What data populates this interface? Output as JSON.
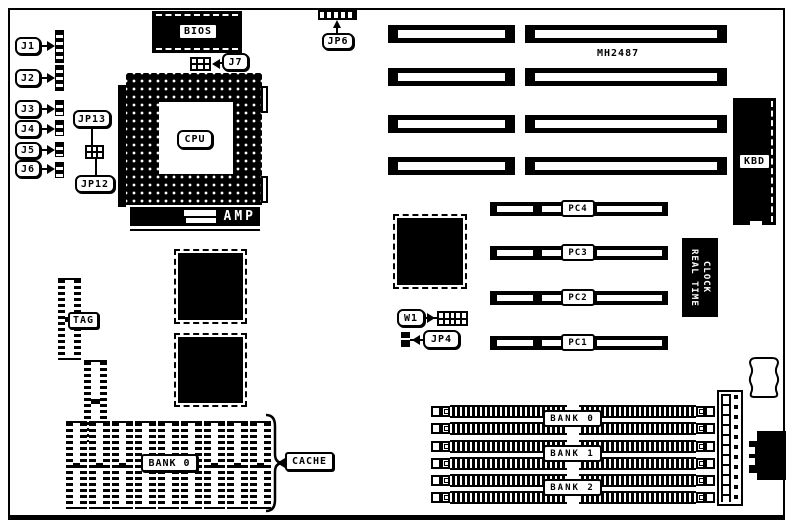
{
  "board": {
    "part_number": "MH2487",
    "left_connectors": [
      "J1",
      "J2",
      "J3",
      "J4",
      "J5",
      "J6"
    ],
    "jumpers": {
      "jp13": "JP13",
      "jp12": "JP12",
      "j7": "J7",
      "jp6": "JP6",
      "w1": "W1",
      "jp4": "JP4"
    },
    "chips": {
      "bios": "BIOS",
      "cpu": "CPU",
      "amp": "AMP",
      "kbd": "KBD",
      "tag": "TAG",
      "rtc_line1": "REAL TIME",
      "rtc_line2": "CLOCK"
    },
    "pci_slots": [
      "PC4",
      "PC3",
      "PC2",
      "PC1"
    ],
    "simm_banks": [
      "BANK 0",
      "BANK 1",
      "BANK 2"
    ],
    "cache": {
      "bank": "BANK 0",
      "label": "CACHE"
    }
  }
}
